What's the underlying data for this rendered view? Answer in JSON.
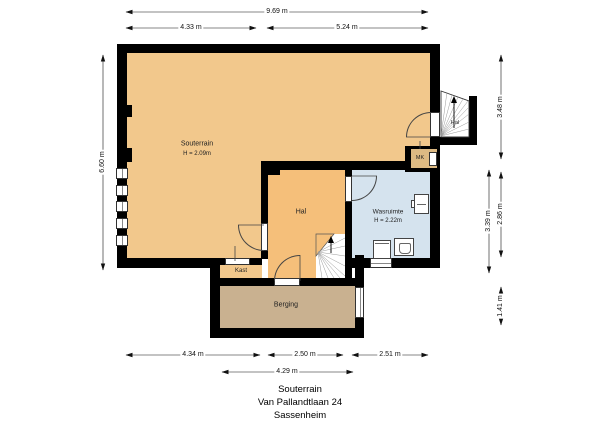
{
  "plan": {
    "floor_name": "Souterrain",
    "address": "Van Pallandtlaan 24",
    "city": "Sassenheim"
  },
  "rooms": {
    "souterrain": {
      "name": "Souterrain",
      "height": "H = 2.09m"
    },
    "hal": {
      "name": "Hal"
    },
    "wasruimte": {
      "name": "Wasruimte",
      "height": "H = 2.22m"
    },
    "kast": {
      "name": "Kast"
    },
    "berging": {
      "name": "Berging"
    },
    "hal_stair_upper": {
      "name": "Hal"
    },
    "meterkast": {
      "name": "MK"
    }
  },
  "dimensions": {
    "top": [
      {
        "label": "9.69 m"
      },
      {
        "label": "4.33 m"
      },
      {
        "label": "5.24 m"
      }
    ],
    "left": [
      {
        "label": "6.60 m"
      }
    ],
    "right": [
      {
        "label": "3.48 m"
      },
      {
        "label": "3.39 m"
      },
      {
        "label": "2.86 m"
      },
      {
        "label": "1.41 m"
      }
    ],
    "bottom": [
      {
        "label": "4.34 m"
      },
      {
        "label": "2.50 m"
      },
      {
        "label": "2.51 m"
      },
      {
        "label": "4.29 m"
      }
    ]
  },
  "colors": {
    "wall": "#000000",
    "souterrain_fill": "#F2C88C",
    "hal_fill": "#F5BF7A",
    "kast_fill": "#F2C88C",
    "wasruimte_fill": "#D5E3EE",
    "berging_fill": "#C9B190",
    "meterkast_fill": "#DDBA83",
    "background": "#FFFFFF"
  }
}
